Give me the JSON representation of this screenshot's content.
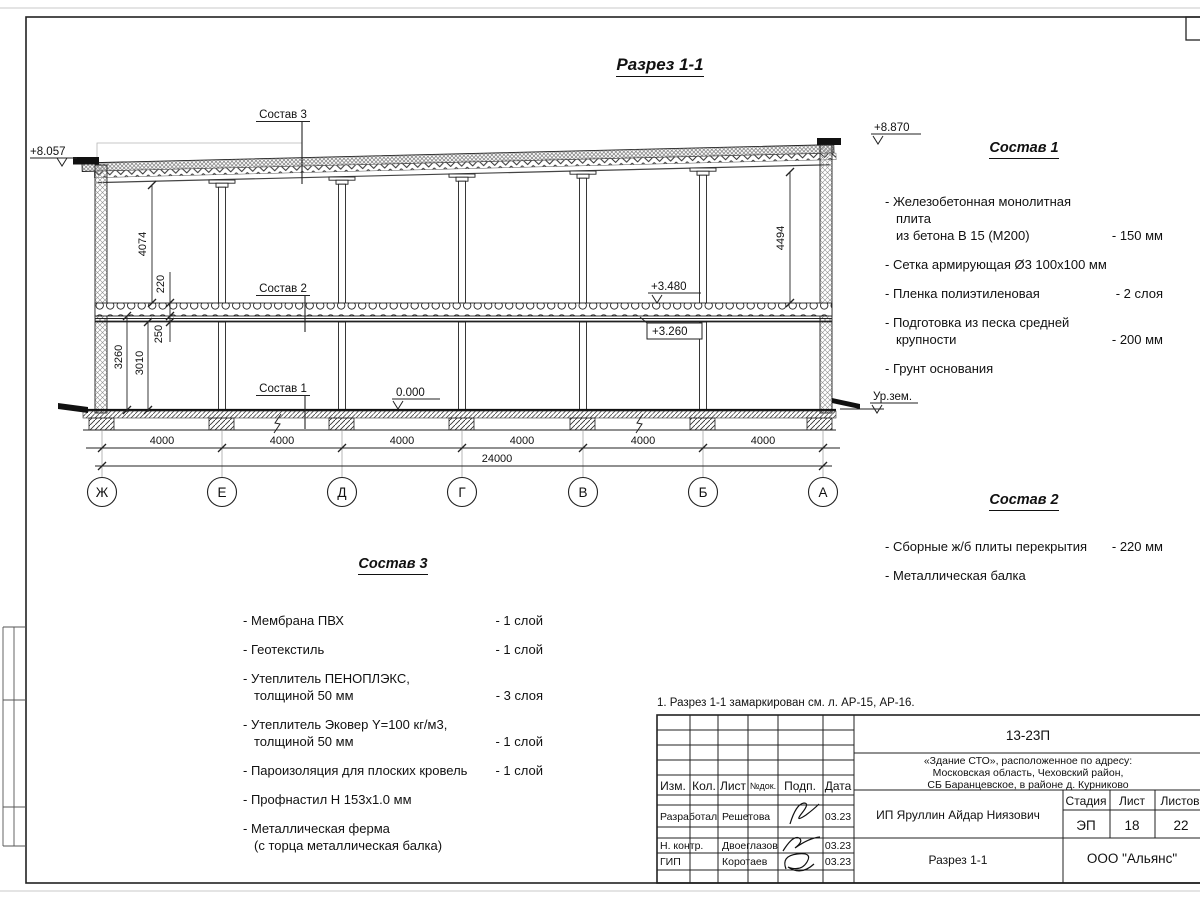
{
  "colors": {
    "ink": "#1a1a1a",
    "paper": "#ffffff"
  },
  "drawing": {
    "title": "Разрез 1-1",
    "axes": [
      "Ж",
      "Е",
      "Д",
      "Г",
      "В",
      "Б",
      "А"
    ],
    "spans": [
      "4000",
      "4000",
      "4000",
      "4000",
      "4000",
      "4000"
    ],
    "total": "24000",
    "vdims": {
      "v4074": "4074",
      "v220": "220",
      "v250": "250",
      "v3260": "3260",
      "v3010": "3010",
      "v4494": "4494"
    },
    "marks": {
      "roof_left": "+8.057",
      "roof_right": "+8.870",
      "slab_top": "+3.480",
      "slab_bot": "+3.260",
      "floor": "0.000",
      "ground": "Ур.зем."
    },
    "callouts": {
      "c1": "Состав 1",
      "c2": "Состав 2",
      "c3": "Состав 3"
    }
  },
  "sostav1": {
    "title": "Состав 1",
    "items": [
      {
        "name": "- Железобетонная  монолитная плита\nиз бетона В 15 (М200)",
        "qty": "- 150 мм"
      },
      {
        "name": "- Сетка армирующая Ø3 100х100 мм",
        "qty": ""
      },
      {
        "name": "- Пленка полиэтиленовая",
        "qty": "-  2 слоя"
      },
      {
        "name": "- Подготовка из песка средней\nкрупности",
        "qty": "- 200 мм"
      },
      {
        "name": "- Грунт основания",
        "qty": ""
      }
    ]
  },
  "sostav2": {
    "title": "Состав 2",
    "items": [
      {
        "name": "- Сборные ж/б плиты перекрытия",
        "qty": "- 220 мм"
      },
      {
        "name": "- Металлическая  балка",
        "qty": ""
      }
    ]
  },
  "sostav3": {
    "title": "Состав 3",
    "items": [
      {
        "name": "- Мембрана ПВХ",
        "qty": "- 1 слой"
      },
      {
        "name": "- Геотекстиль",
        "qty": "- 1 слой"
      },
      {
        "name": "- Утеплитель ПЕНОПЛЭКС,\nтолщиной 50 мм",
        "qty": "- 3 слоя"
      },
      {
        "name": "- Утеплитель Эковер Y=100 кг/м3,\nтолщиной 50 мм",
        "qty": "- 1 слой"
      },
      {
        "name": "- Пароизоляция для плоских кровель",
        "qty": "- 1 слой"
      },
      {
        "name": "- Профнастил Н 153х1.0 мм",
        "qty": ""
      },
      {
        "name": "- Металлическая ферма\n(с торца металлическая балка)",
        "qty": ""
      }
    ]
  },
  "notes": {
    "n1": "1. Разрез 1-1 замаркирован см. л. АР-15, АР-16."
  },
  "titleblock": {
    "doc_number": "13-23П",
    "project_lines": [
      "«Здание СТО», расположенное по адресу:",
      "Московская область, Чеховский район,",
      "СБ Баранцевское, в районе д. Курниково"
    ],
    "client": "ИП Яруллин Айдар Ниязович",
    "sheet_title": "Разрез 1-1",
    "company": "ООО \"Альянс\"",
    "cols": {
      "izm": "Изм.",
      "kol": "Кол.",
      "list": "Лист",
      "ndok": "№док.",
      "podp": "Подп.",
      "data": "Дата"
    },
    "stage_header": {
      "stage": "Стадия",
      "sheet": "Лист",
      "sheets": "Листов"
    },
    "stage_values": {
      "stage": "ЭП",
      "sheet": "18",
      "sheets": "22"
    },
    "rows": [
      {
        "role": "Разработал",
        "name": "Решетова",
        "date": "03.23"
      },
      {
        "role": "Н. контр.",
        "name": "Двоеглазов",
        "date": "03.23"
      },
      {
        "role": "ГИП",
        "name": "Коротаев",
        "date": "03.23"
      }
    ]
  }
}
